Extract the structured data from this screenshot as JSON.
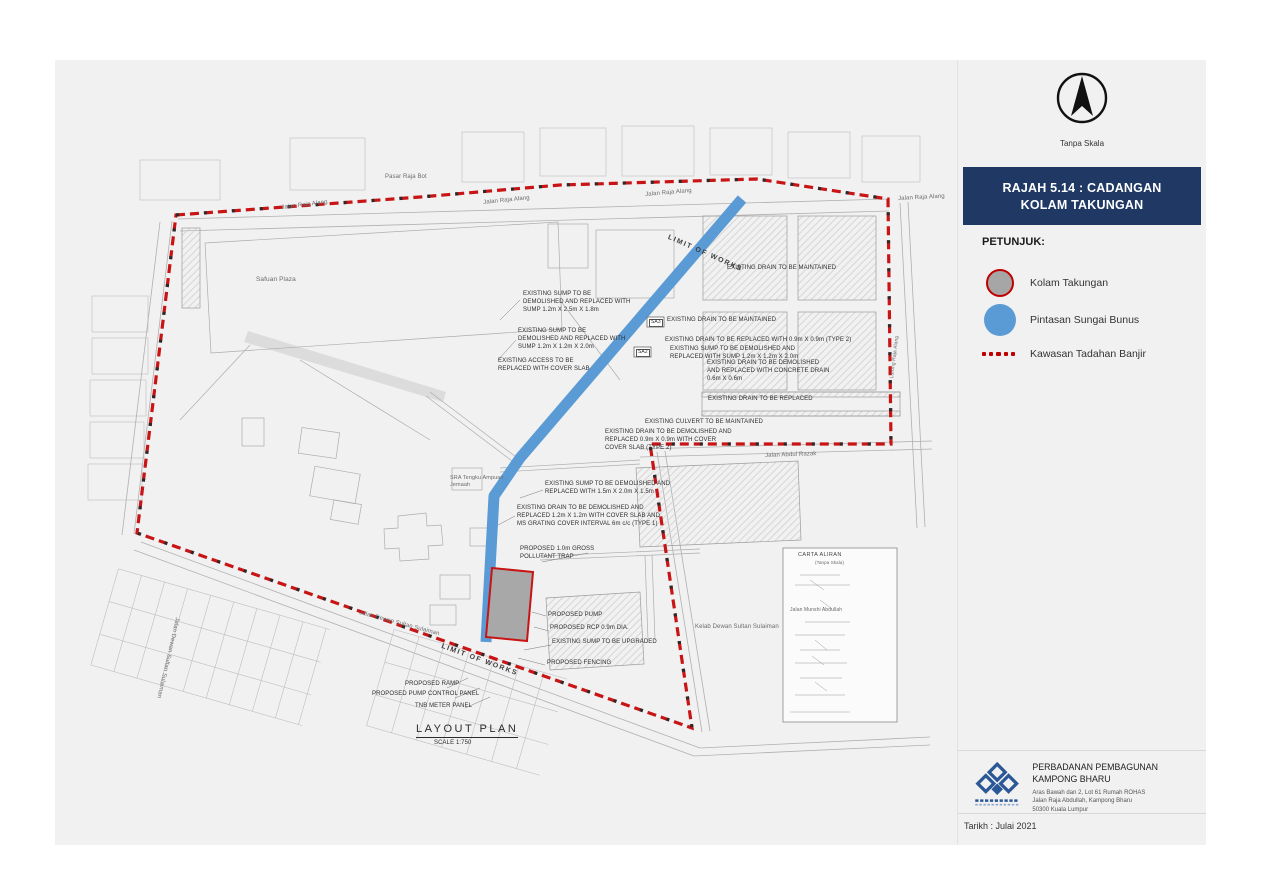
{
  "colors": {
    "panel_bg": "#f1f1f1",
    "title_bg": "#1f3864",
    "boundary_red": "#c81414",
    "river_blue": "#5b9bd5",
    "pond_gray": "#a8a8a8",
    "legend_red": "#c00000"
  },
  "sidebar": {
    "north_arrow_label": "Tanpa Skala",
    "title_line1": "RAJAH 5.14 : CADANGAN",
    "title_line2": "KOLAM TAKUNGAN",
    "legend_heading": "PETUNJUK:",
    "legend": [
      {
        "symbol": "pond-circle-icon",
        "label": "Kolam Takungan"
      },
      {
        "symbol": "blue-circle-icon",
        "label": "Pintasan Sungai Bunus"
      },
      {
        "symbol": "red-dotted-line-icon",
        "label": "Kawasan Tadahan Banjir"
      }
    ],
    "org_name": "PERBADANAN PEMBAGUNAN KAMPONG BHARU",
    "org_addr_line1": "Aras Bawah dan 2, Lot 61 Rumah ROHAS",
    "org_addr_line2": "Jalan Raja Abdullah, Kampong Bharu",
    "org_addr_line3": "50300 Kuala Lumpur",
    "date_label": "Tarikh : Julai 2021"
  },
  "map": {
    "annotations": [
      {
        "t": "Pasar Raja Bot",
        "x": 385,
        "y": 174,
        "fs": 6,
        "cls": "street"
      },
      {
        "t": "Jalan Raja Alang",
        "x": 281,
        "y": 205,
        "fs": 6,
        "rot": -7,
        "cls": "street"
      },
      {
        "t": "Jalan Raja Alang",
        "x": 483,
        "y": 200,
        "fs": 6,
        "rot": -6,
        "cls": "street"
      },
      {
        "t": "Jalan Raja Alang",
        "x": 645,
        "y": 192,
        "fs": 6,
        "rot": -5,
        "cls": "street"
      },
      {
        "t": "Jalan Raja Alang",
        "x": 898,
        "y": 196,
        "fs": 6,
        "rot": -3,
        "cls": "street"
      },
      {
        "t": "Safuan Plaza",
        "x": 256,
        "y": 276,
        "fs": 6.5,
        "cls": "street"
      },
      {
        "t": "LIMIT OF WORKS",
        "x": 670,
        "y": 233,
        "fs": 7,
        "rot": 24,
        "cls": "limit"
      },
      {
        "t": "EXISTING SUMP TO BE\nDEMOLISHED AND REPLACED WITH\nSUMP 1.2m X 2.5m X 1.8m",
        "x": 523,
        "y": 291,
        "fs": 6
      },
      {
        "t": "EXISTING DRAIN TO BE MAINTAINED",
        "x": 727,
        "y": 265,
        "fs": 6
      },
      {
        "t": "EXISTING SUMP TO BE\nDEMOLISHED AND REPLACED WITH\nSUMP 1.2m X 1.2m X 2.0m",
        "x": 518,
        "y": 328,
        "fs": 6
      },
      {
        "t": "EXISTING DRAIN TO BE MAINTAINED",
        "x": 667,
        "y": 317,
        "fs": 6
      },
      {
        "t": "EXISTING DRAIN TO BE REPLACED WITH 0.9m X 0.9m (TYPE 2)",
        "x": 665,
        "y": 337,
        "fs": 6
      },
      {
        "t": "EXISTING SUMP TO BE DEMOLISHED AND\nREPLACED WITH SUMP 1.2m X 1.2m X 2.0m",
        "x": 670,
        "y": 346,
        "fs": 6
      },
      {
        "t": "EXISTING DRAIN TO BE DEMOLISHED\nAND REPLACED WITH CONCRETE DRAIN\n0.6m X 0.6m",
        "x": 707,
        "y": 360,
        "fs": 6
      },
      {
        "t": "EXISTING ACCESS TO BE\nREPLACED WITH COVER SLAB",
        "x": 498,
        "y": 358,
        "fs": 6
      },
      {
        "t": "EXISTING DRAIN TO BE REPLACED",
        "x": 708,
        "y": 396,
        "fs": 6
      },
      {
        "t": "EXISTING CULVERT TO BE MAINTAINED",
        "x": 645,
        "y": 419,
        "fs": 6
      },
      {
        "t": "EXISTING DRAIN TO BE DEMOLISHED AND\nREPLACED 0.9m X 0.9m WITH COVER\nCOVER SLAB (TYPE 2)",
        "x": 605,
        "y": 429,
        "fs": 6
      },
      {
        "t": "Jalan Abdul Razak",
        "x": 765,
        "y": 453,
        "fs": 6,
        "rot": -2,
        "cls": "street"
      },
      {
        "t": "SRA Tengku Ampuan\nJemaah",
        "x": 450,
        "y": 475,
        "fs": 5.5,
        "cls": "street"
      },
      {
        "t": "EXISTING SUMP TO BE DEMOLISHED AND\nREPLACED WITH 1.5m X 2.0m X 1.5m",
        "x": 545,
        "y": 481,
        "fs": 6
      },
      {
        "t": "EXISTING DRAIN TO BE DEMOLISHED AND\nREPLACED 1.2m X 1.2m WITH COVER SLAB AND\nMS GRATING COVER INTERVAL 6m c/c (TYPE 1)",
        "x": 517,
        "y": 505,
        "fs": 6
      },
      {
        "t": "PROPOSED 1.0m GROSS\nPOLLUTANT TRAP",
        "x": 520,
        "y": 546,
        "fs": 6
      },
      {
        "t": "PROPOSED PUMP",
        "x": 548,
        "y": 612,
        "fs": 6
      },
      {
        "t": "PROPOSED RCP 0.9m DIA.",
        "x": 550,
        "y": 625,
        "fs": 6
      },
      {
        "t": "EXISTING SUMP TO BE UPGRADED",
        "x": 552,
        "y": 639,
        "fs": 6
      },
      {
        "t": "PROPOSED FENCING",
        "x": 547,
        "y": 660,
        "fs": 6
      },
      {
        "t": "LIMIT OF WORKS",
        "x": 443,
        "y": 642,
        "fs": 7,
        "rot": 20,
        "cls": "limit"
      },
      {
        "t": "PROPOSED RAMP",
        "x": 405,
        "y": 681,
        "fs": 6
      },
      {
        "t": "PROPOSED PUMP CONTROL PANEL",
        "x": 372,
        "y": 691,
        "fs": 6
      },
      {
        "t": "TNB METER PANEL",
        "x": 415,
        "y": 703,
        "fs": 6
      },
      {
        "t": "LAYOUT PLAN",
        "x": 416,
        "y": 722,
        "fs": 11,
        "cls": "plan-title"
      },
      {
        "t": "SCALE 1:750",
        "x": 434,
        "y": 740,
        "fs": 6
      },
      {
        "t": "Jalan Dewan Sultan Sulaiman",
        "x": 360,
        "y": 610,
        "fs": 6,
        "rot": 15,
        "cls": "street"
      },
      {
        "t": "Jalan Dewan Sultan Sulaiman",
        "x": 180,
        "y": 618,
        "fs": 6,
        "rot": 103,
        "cls": "street"
      },
      {
        "t": "Kelab Dewan Sultan Sulaiman",
        "x": 695,
        "y": 624,
        "fs": 6,
        "cls": "street"
      },
      {
        "t": "Lorong Raja Alang",
        "x": 889,
        "y": 378,
        "fs": 5,
        "rot": -83,
        "cls": "street"
      },
      {
        "t": "CARTA ALIRAN",
        "x": 798,
        "y": 552,
        "fs": 5.5,
        "cls": "carta-title"
      },
      {
        "t": "(Tanpa Skala)",
        "x": 815,
        "y": 560,
        "fs": 4.5,
        "cls": "street"
      },
      {
        "t": "Jalan Munshi Abdullah",
        "x": 790,
        "y": 607,
        "fs": 5,
        "cls": "street"
      },
      {
        "t": "SA3",
        "x": 649,
        "y": 319,
        "fs": 5,
        "cls": "sa"
      },
      {
        "t": "SA2",
        "x": 636,
        "y": 349,
        "fs": 5,
        "cls": "sa"
      }
    ]
  }
}
